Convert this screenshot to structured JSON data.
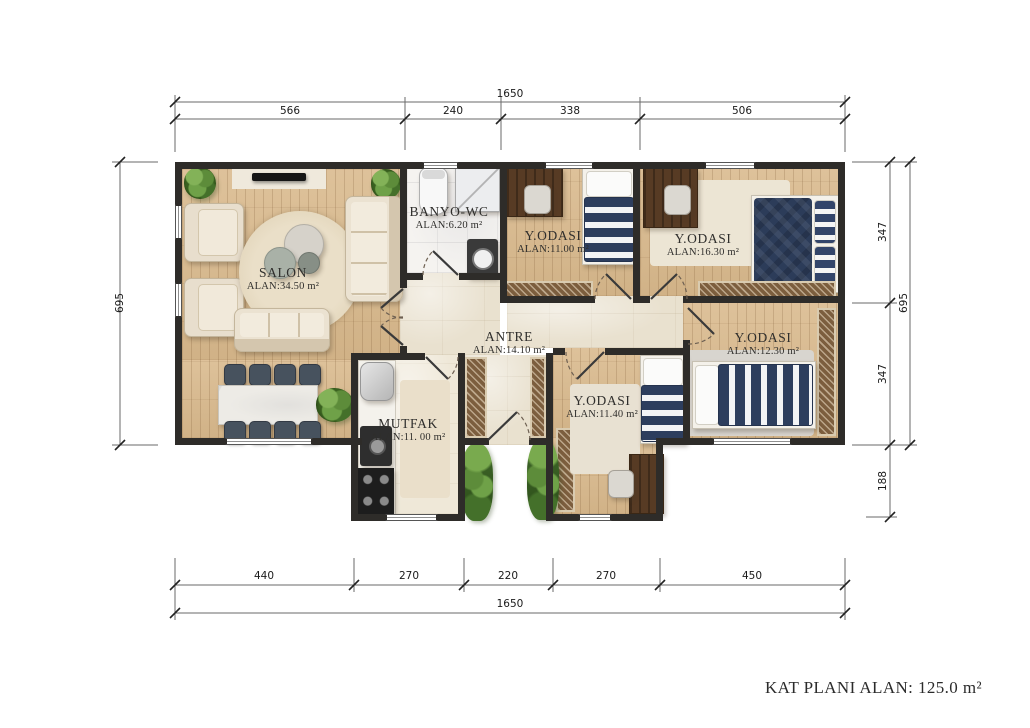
{
  "footer": {
    "text": "KAT PLANI ALAN: 125.0 m²"
  },
  "rooms": {
    "salon": {
      "name": "SALON",
      "area": "ALAN:34.50 m²"
    },
    "banyo": {
      "name": "BANYO-WC",
      "area": "ALAN:6.20 m²"
    },
    "bedroom1": {
      "name": "Y.ODASI",
      "area": "ALAN:11.00 m²"
    },
    "bedroom2": {
      "name": "Y.ODASI",
      "area": "ALAN:16.30 m²"
    },
    "bedroom3": {
      "name": "Y.ODASI",
      "area": "ALAN:12.30 m²"
    },
    "bedroom4": {
      "name": "Y.ODASI",
      "area": "ALAN:11.40 m²"
    },
    "antre": {
      "name": "ANTRE",
      "area": "ALAN:14.10 m²"
    },
    "mutfak": {
      "name": "MUTFAK",
      "area": "ALAN:11. 00 m²"
    }
  },
  "dimensions": {
    "top": {
      "total": "1650",
      "segments": [
        "566",
        "240",
        "338",
        "506"
      ]
    },
    "bottom": {
      "total": "1650",
      "segments": [
        "440",
        "270",
        "220",
        "270",
        "450"
      ]
    },
    "left": {
      "total": "695"
    },
    "right": {
      "total": "695",
      "segments": [
        "347",
        "347",
        "188"
      ]
    }
  },
  "colors": {
    "wall": "#2e2c29",
    "wood": "#d9b98c",
    "travertine": "#e9e1cf",
    "navy": "#2d3e5e",
    "wardrobe": "#7c5e3e"
  }
}
